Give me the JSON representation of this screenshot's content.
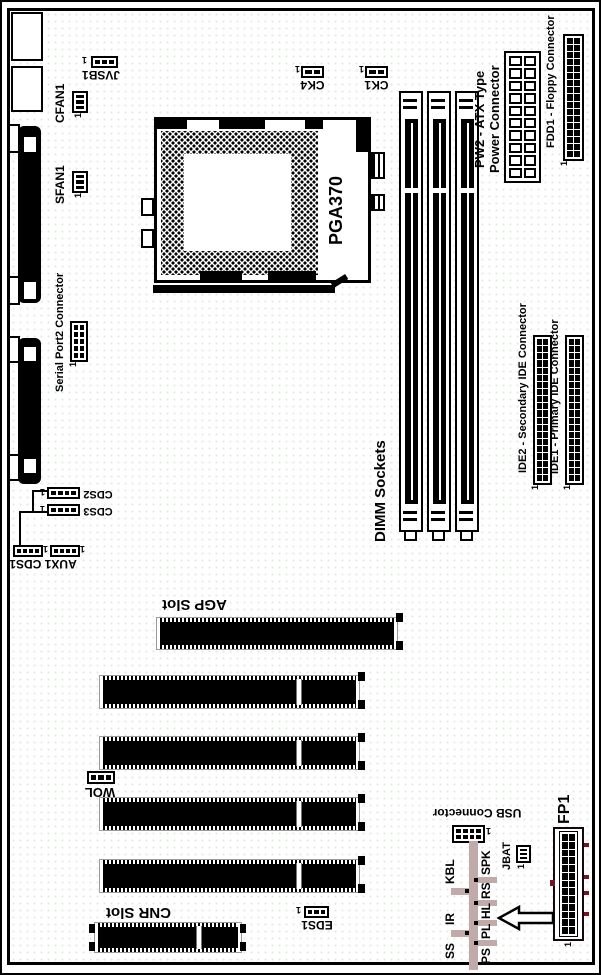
{
  "colors": {
    "accent_red": "#7a1022",
    "table_gray": "#c3aaaa",
    "slot_outline": "#9a9a9a"
  },
  "labels": {
    "jvsb1": "JVSB1",
    "cfan1": "CFAN1",
    "sfan1": "SFAN1",
    "serial_port2": "Serial Port2 Connector",
    "ck4": "CK4",
    "ck1": "CK1",
    "pga370": "PGA370",
    "pw2_line1": "PW2 - ATX Type",
    "pw2_line2": "Power Connector",
    "fdd1": "FDD1 - Floppy Connector",
    "dimm": "DIMM Sockets",
    "ide2": "IDE2 - Secondary IDE Connector",
    "ide1": "IDE1 - Primary IDE Connector",
    "cds2": "CDS2",
    "cds3": "CDS3",
    "aux1_cds1": "AUX1 CDS1",
    "agp": "AGP Slot",
    "wol": "WOL",
    "cnr": "CNR Slot",
    "eds1": "EDS1",
    "usb": "USB Connector",
    "jbat": "JBAT",
    "fp1": "FP1",
    "pin1": "1"
  },
  "front_panel": {
    "column_a": [
      "SS",
      "IR",
      "KBL"
    ],
    "column_b": [
      "PS",
      "PL",
      "HL",
      "RS",
      "SPK"
    ]
  }
}
